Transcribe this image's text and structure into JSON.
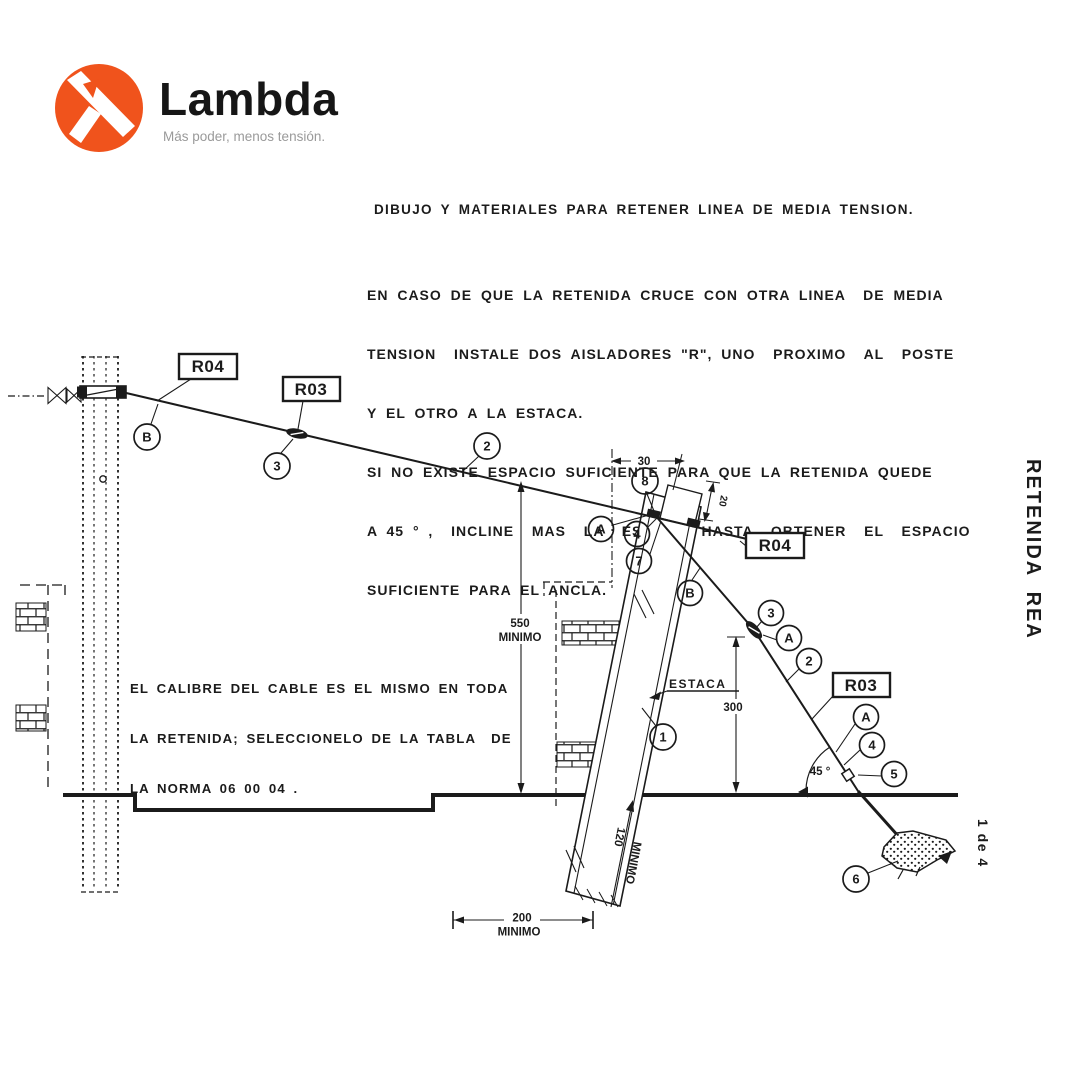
{
  "colors": {
    "accent": "#F0531C",
    "ink": "#1b1b1b",
    "muted": "#9a9a9a"
  },
  "logo": {
    "name": "Lambda",
    "tagline": "Más poder, menos tensión."
  },
  "side": {
    "vertical_title": "RETENIDA  REA",
    "sheet": "1 de 4"
  },
  "heading": "DIBUJO Y MATERIALES PARA RETENER LINEA DE MEDIA TENSION.",
  "instructions": {
    "lines": [
      "EN CASO DE QUE LA RETENIDA CRUCE CON OTRA LINEA  DE MEDIA",
      "TENSION  INSTALE DOS AISLADORES \"R\", UNO  PROXIMO  AL  POSTE",
      "Y EL OTRO A LA ESTACA.",
      "SI NO EXISTE ESPACIO SUFICIENTE PARA QUE LA RETENIDA QUEDE",
      "A 45 ° ,  INCLINE  MAS  LA  ESTACA  HASTA  OBTENER  EL  ESPACIO",
      "SUFICIENTE PARA EL ANCLA."
    ]
  },
  "note": {
    "lines": [
      "EL CALIBRE DEL CABLE ES EL MISMO EN TODA",
      "LA RETENIDA; SELECCIONELO DE LA TABLA  DE",
      "LA NORMA 06 00 04 ."
    ]
  },
  "diagram": {
    "ref_boxes": {
      "pole_r04": "R04",
      "pole_r03": "R03",
      "stake_r04": "R04",
      "stake_r03": "R03"
    },
    "markers": [
      "B",
      "3",
      "2",
      "8",
      "A",
      "4",
      "7",
      "B",
      "3",
      "A",
      "2",
      "A",
      "4",
      "5",
      "6",
      "1"
    ],
    "stake_label": "ESTACA",
    "angle_label": "45 °",
    "dimensions": {
      "width_top": "30",
      "offset_top": "20",
      "height_min": "550",
      "stake_height": "300",
      "depth_min": "120",
      "spacing_min": "200",
      "minimo": "MINIMO"
    }
  }
}
